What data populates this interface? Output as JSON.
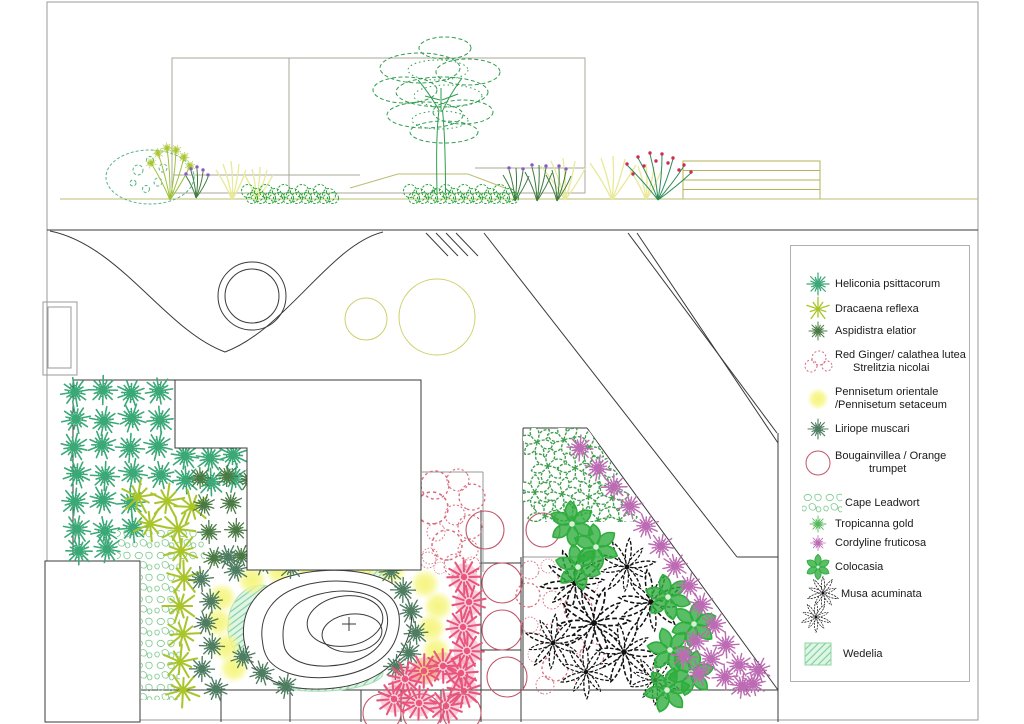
{
  "document": {
    "type": "landscape garden design drawing",
    "views": {
      "top": "planting elevation",
      "bottom": "planting plan"
    }
  },
  "legend": {
    "items": [
      {
        "id": "heliconia",
        "label": "Heliconia psittacorum",
        "icon": "burst-teal-icon"
      },
      {
        "id": "dracaena",
        "label": "Dracaena reflexa",
        "icon": "star-lime-icon"
      },
      {
        "id": "aspidistra",
        "label": "Aspidistra elatior",
        "icon": "burst-darkgreen-icon"
      },
      {
        "id": "red-ginger",
        "label": "Red Ginger/ calathea lutea",
        "label2": "Strelitzia nicolai",
        "icon": "dotted-circles-pink-icon"
      },
      {
        "id": "pennisetum",
        "label": "Pennisetum orientale",
        "label2": "/Pennisetum setaceum",
        "icon": "yellow-blob-icon"
      },
      {
        "id": "liriope",
        "label": "Liriope muscari",
        "icon": "burst-tealdark-icon"
      },
      {
        "id": "bougainvillea",
        "label": "Bougainvillea / Orange",
        "label2": "trumpet",
        "icon": "red-circle-icon"
      },
      {
        "id": "cape-leadwort",
        "label": "Cape Leadwort",
        "icon": "speckle-rect-icon"
      },
      {
        "id": "tropicanna",
        "label": "Tropicanna gold",
        "icon": "burst-green-small-icon"
      },
      {
        "id": "cordyline",
        "label": "Cordyline fruticosa",
        "icon": "burst-violet-small-icon"
      },
      {
        "id": "colocasia",
        "label": "Colocasia",
        "icon": "leaf-star-green-icon"
      },
      {
        "id": "musa",
        "label": "Musa acuminata",
        "icon": "palm-black-icon"
      },
      {
        "id": "wedelia",
        "label": "Wedelia",
        "icon": "hatch-square-green-icon"
      }
    ]
  },
  "colors": {
    "heliconia": "#3aa877",
    "dracaena": "#a9c52b",
    "aspidistra": "#4a7a43",
    "red_ginger": "#d96a7b",
    "pennisetum": "#f5f57c",
    "liriope": "#4e7d62",
    "bougainvillea": "#c2566b",
    "cape_leadwort": "#7cc98c",
    "tropicanna": "#55b85c",
    "cordyline": "#bd6cb4",
    "colocasia": "#2fae3e",
    "colocasia_pattern": "#3f9e4d",
    "musa": "#1a1a1a",
    "wedelia": "#82cf9b",
    "pompom": "#e8557d",
    "tree": "#2f9e4f",
    "frame": "#9a9a9a",
    "line": "#3a3a3a",
    "olive": "#cdd06a"
  }
}
